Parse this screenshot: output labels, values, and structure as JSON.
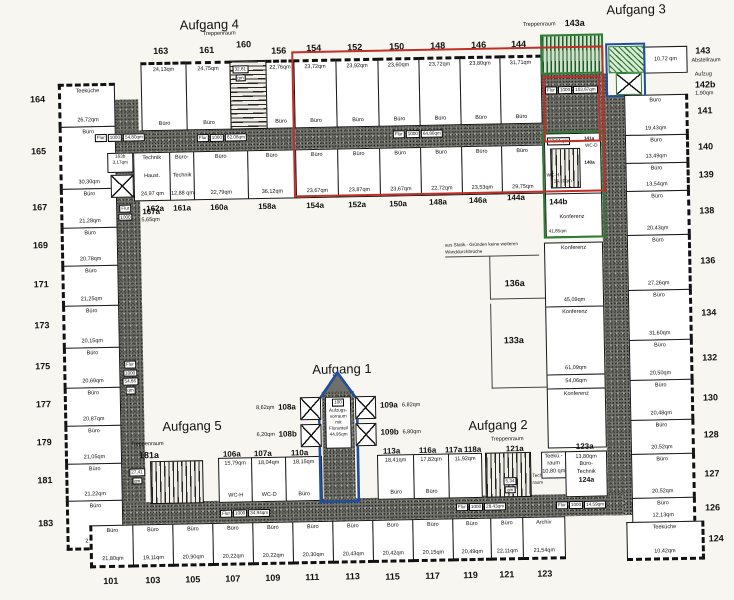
{
  "colors": {
    "red": "#c03028",
    "green": "#2f7d33",
    "blue": "#1f4e9c"
  },
  "headings": {
    "a1": "Aufgang 1",
    "a2": "Aufgang 2",
    "a3": "Aufgang 3",
    "a4": "Aufgang 4",
    "a5": "Aufgang 5",
    "treppenraum": "Treppenraum"
  },
  "stairs": {
    "s160": "160",
    "s143a": "143a",
    "s181a": "181a",
    "s121a": "121a",
    "s160_area": "32,81",
    "s181_area": "27,41",
    "qm": "qm"
  },
  "chips": {
    "flur": "Flur",
    "code": "1000",
    "top_left": "54,80qm",
    "top_mid": "62,06qm",
    "top_right": "64,80qm",
    "corner_tr": "103,87qm",
    "bottom_left": "34,94qm",
    "bottom_mid": "28,43qm",
    "bottom_right": "14,59qm",
    "left_wing": "54,66",
    "left_wing_qm": "qm",
    "f167a_num": "167a",
    "f167a_area": "5,65qm"
  },
  "left": [
    {
      "n": "164",
      "t": "Teeküche",
      "a": "26,72qm"
    },
    {
      "n": "165",
      "t": "Büro",
      "a": "30,30qm"
    },
    {
      "n": "167",
      "t": "Büro",
      "a": "21,28qm"
    },
    {
      "n": "169",
      "t": "Büro",
      "a": "20,78qm"
    },
    {
      "n": "171",
      "t": "Büro",
      "a": "21,25qm"
    },
    {
      "n": "173",
      "t": "Büro",
      "a": "20,15qm"
    },
    {
      "n": "175",
      "t": "Büro",
      "a": "20,69qm"
    },
    {
      "n": "177",
      "t": "Büro",
      "a": "20,87qm"
    },
    {
      "n": "179",
      "t": "Büro",
      "a": "21,05qm"
    },
    {
      "n": "181",
      "t": "Büro",
      "a": "21,22qm"
    },
    {
      "n": "183",
      "t": "Büro",
      "a": "21,47qm"
    }
  ],
  "top": [
    {
      "n": "163",
      "t": "Büro",
      "a": "24,13qm"
    },
    {
      "n": "161",
      "t": "Büro",
      "a": "24,75qm"
    },
    {
      "n": "156",
      "t": "Büro",
      "a": "22,76qm"
    },
    {
      "n": "154",
      "t": "Büro",
      "a": "23,72qm"
    },
    {
      "n": "152",
      "t": "Büro",
      "a": "23,92qm"
    },
    {
      "n": "150",
      "t": "Büro",
      "a": "23,60qm"
    },
    {
      "n": "148",
      "t": "Büro",
      "a": "23,72qm"
    },
    {
      "n": "146",
      "t": "Büro",
      "a": "23,80qm"
    },
    {
      "n": "144",
      "t": "Büro",
      "a": "31,71qm"
    }
  ],
  "top_inner": [
    {
      "n": "160a",
      "t": "Büro",
      "a": "22,79qm"
    },
    {
      "n": "158a",
      "t": "Büro",
      "a": "36,12qm"
    },
    {
      "n": "154a",
      "t": "Büro",
      "a": "23,67qm"
    },
    {
      "n": "152a",
      "t": "Büro",
      "a": "23,87qm"
    },
    {
      "n": "150a",
      "t": "Büro",
      "a": "23,67qm"
    },
    {
      "n": "148a",
      "t": "Büro",
      "a": "22,72qm"
    },
    {
      "n": "146a",
      "t": "Büro",
      "a": "23,53qm"
    },
    {
      "n": "144a",
      "t": "Büro",
      "a": "29,75qm"
    }
  ],
  "tech": {
    "n163b": "163b",
    "a163b": "3,17qm",
    "technik": "Technik",
    "haust": "Haust.",
    "haust_a": "24,97 qm",
    "bt1": "Büro-",
    "bt2": "Technik",
    "bt_a": "12,88 qm",
    "n162a": "162a",
    "n161a": "161a"
  },
  "right": [
    {
      "n": "141",
      "t": "Büro",
      "a": "19,43qm"
    },
    {
      "n": "140",
      "t": "Büro",
      "a": "13,49qm"
    },
    {
      "n": "139",
      "t": "Büro",
      "a": "13,54qm"
    },
    {
      "n": "138",
      "t": "Büro",
      "a": "20,43qm"
    },
    {
      "n": "136",
      "t": "Büro",
      "a": "27,26qm"
    },
    {
      "n": "134",
      "t": "Büro",
      "a": "31,60qm"
    },
    {
      "n": "132",
      "t": "Büro",
      "a": "20,50qm"
    },
    {
      "n": "130",
      "t": "Büro",
      "a": "20,48qm"
    },
    {
      "n": "128",
      "t": "Büro",
      "a": "20,52qm"
    },
    {
      "n": "127",
      "t": "Büro",
      "a": "20,52qm"
    },
    {
      "n": "126",
      "t": "Büro",
      "a": "12,13qm"
    },
    {
      "n": "124",
      "t": "Teeküche",
      "a": "10,42qm"
    }
  ],
  "r143": {
    "num": "143",
    "name": "Abstellraum",
    "area": "10,72 qm",
    "aufzug": "Aufzug",
    "num2": "142b",
    "area2": "1,90qm"
  },
  "conf": {
    "wc_area": "13,64 qm",
    "wc_d_num": "141a",
    "wc_d": "WC-D",
    "wc_h_num": "140a",
    "wc_h": "WC-H",
    "wc_h_area": "14,10qm",
    "k144b_num": "144b",
    "k144b": "Konferenz",
    "k144b_area": "41,85qm",
    "k136a": "Konferenz",
    "k136a_area": "45,09qm",
    "k136a_label": "136a",
    "k133a": "Konferenz",
    "k133a_area": "61,09qm",
    "k133a_label": "133a",
    "small_area": "54,06qm",
    "k5": "Konferenz"
  },
  "note": {
    "line1": "aus Statik.- Gründen keine weiteren",
    "line2": "Wanddurchbrüche"
  },
  "tower": {
    "chip": "100",
    "t1": "Aufzugs-",
    "t2": "vorraum",
    "t3": "mit",
    "t4": "Fluranteil",
    "area": "44,95qm",
    "a108a": "8,62qm",
    "n108a": "108a",
    "a108b": "6,20qm",
    "n108b": "108b",
    "n109a": "109a",
    "a109a": "6,82qm",
    "n109b": "109b",
    "a109b": "6,80qm"
  },
  "bottom_inner": {
    "n106a": "106a",
    "a106a": "15,79qm",
    "wch": "WC-H",
    "n107a": "107a",
    "a107a": "18,04qm",
    "wcd": "WC-D",
    "n110a": "110a",
    "a110a": "18,15qm",
    "buero": "Büro",
    "n113a": "113a",
    "a113a": "18,41qm",
    "n116a": "116a",
    "a116a": "17,82qm",
    "n117a": "117a",
    "n118a": "118a",
    "a117a": "11,92qm",
    "small": "5,34",
    "small_qm": "qm",
    "techn1": "Techn.-",
    "techn2": "raum",
    "teek1": "Teekü.-",
    "teek2": "raum",
    "teek_area": "10,80 qm",
    "n123a": "123a",
    "bt_area": "13,80qm",
    "bt1": "Büro-",
    "bt2": "Technik",
    "n124a": "124a"
  },
  "bottom": [
    {
      "n": "101",
      "t": "Büro",
      "a": "21,80qm"
    },
    {
      "n": "103",
      "t": "Büro",
      "a": "19,11qm"
    },
    {
      "n": "105",
      "t": "Büro",
      "a": "20,90qm"
    },
    {
      "n": "107",
      "t": "Büro",
      "a": "20,22qm"
    },
    {
      "n": "109",
      "t": "Büro",
      "a": "20,22qm"
    },
    {
      "n": "111",
      "t": "Büro",
      "a": "20,30qm"
    },
    {
      "n": "113",
      "t": "Büro",
      "a": "20,43qm"
    },
    {
      "n": "115",
      "t": "Büro",
      "a": "20,42qm"
    },
    {
      "n": "117",
      "t": "Büro",
      "a": "20,15qm"
    },
    {
      "n": "119",
      "t": "Büro",
      "a": "20,49qm"
    },
    {
      "n": "121",
      "t": "Büro",
      "a": "22,11qm"
    },
    {
      "n": "123",
      "t": "Archiv",
      "a": "21,54qm"
    }
  ]
}
